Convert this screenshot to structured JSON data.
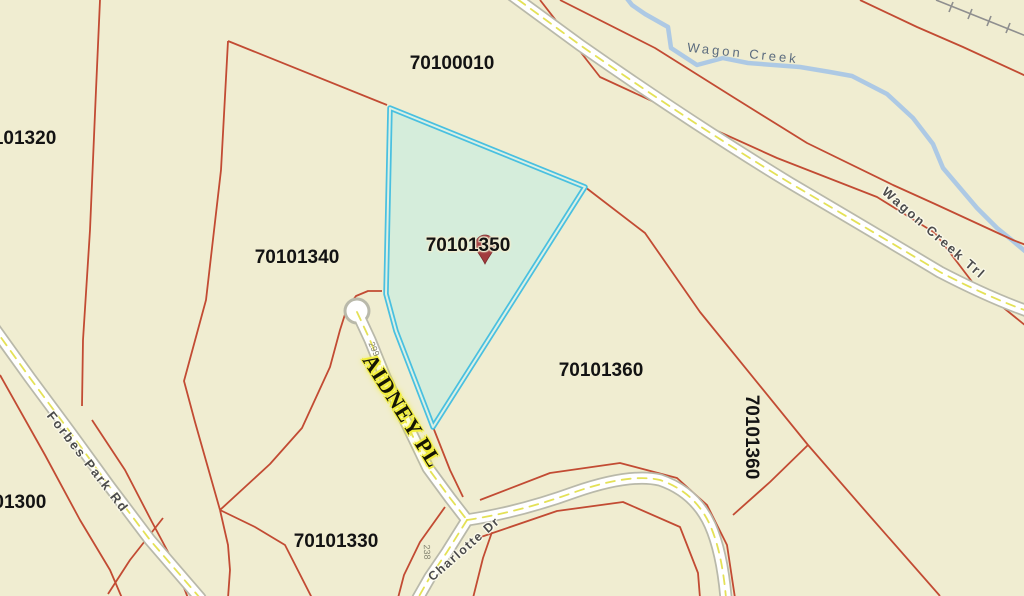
{
  "map": {
    "colors": {
      "background": "#f0edd1",
      "parcel_line": "#c24b33",
      "road_fill": "#ffffff",
      "road_casing": "#b9b9aa",
      "road_centerline": "#e3df4e",
      "creek": "#a9c7e5",
      "railroad": "#8f8f8f",
      "highlight_fill": "#d3ecdc",
      "highlight_border": "#49c0e0",
      "pin": "#a23b3e"
    },
    "selected_parcel": {
      "id": "70101350"
    },
    "parcel_labels": [
      {
        "text": "70100010"
      },
      {
        "text": "70101320"
      },
      {
        "text": "70101340"
      },
      {
        "text": "70101350"
      },
      {
        "text": "70101360"
      },
      {
        "text": "70101360"
      },
      {
        "text": "70101300"
      },
      {
        "text": "70101330"
      }
    ],
    "road_labels": [
      {
        "text": "Forbes Park Rd"
      },
      {
        "text": "AIDNEY PL"
      },
      {
        "text": "Charlotte Dr"
      },
      {
        "text": "Wagon Creek Trl"
      }
    ],
    "water_labels": [
      {
        "text": "Wagon Creek"
      }
    ],
    "address_labels": [
      {
        "text": "299"
      },
      {
        "text": "238"
      }
    ]
  }
}
